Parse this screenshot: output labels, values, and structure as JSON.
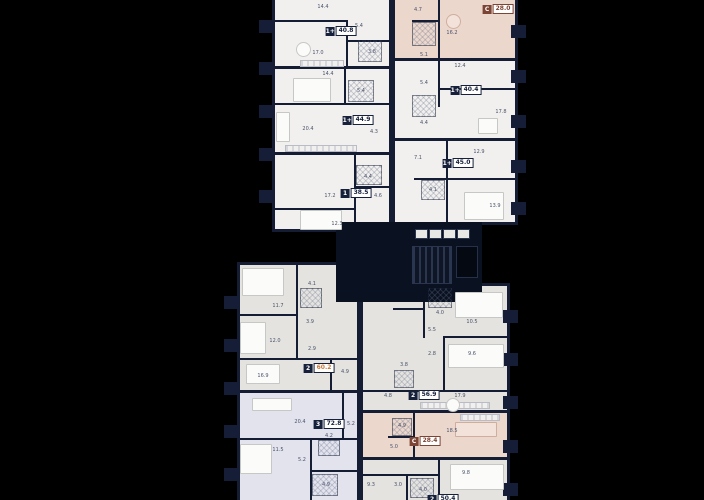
{
  "plan": {
    "name": "residential floor plan",
    "colors": {
      "background": "#000000",
      "wall": "#141d33",
      "floor_white": "#f1f0ee",
      "floor_gray": "#e4e3e0",
      "floor_pink": "#ecd7cd",
      "floor_lavender": "#e3e3ee",
      "badge_navy": "#16203a",
      "badge_brown": "#7b4434",
      "area_highlight_orange": "#c7793c",
      "room_label_text": "#49536b"
    }
  },
  "units": [
    {
      "type": "1+",
      "area": "40.8",
      "rooms": [
        "14.4",
        "5.4",
        "17.0",
        "3.8"
      ]
    },
    {
      "type": "1+",
      "area": "44.9",
      "rooms": [
        "14.4",
        "5.4",
        "20.4",
        "4.3"
      ]
    },
    {
      "type": "1",
      "area": "38.5",
      "rooms": [
        "4.4",
        "17.2",
        "4.6",
        "12.3"
      ]
    },
    {
      "type": "С",
      "area": "28.0",
      "rooms": [
        "4.7",
        "5.1",
        "16.2"
      ]
    },
    {
      "type": "1+",
      "area": "40.4",
      "rooms": [
        "12.4",
        "5.4",
        "4.4",
        "17.8"
      ]
    },
    {
      "type": "1+",
      "area": "45.0",
      "rooms": [
        "12.9",
        "7.1",
        "4.1",
        "13.9"
      ]
    },
    {
      "type": "2",
      "area": "60.2",
      "rooms": [
        "11.7",
        "4.1",
        "3.9",
        "12.0",
        "2.9",
        "16.9",
        "4.9"
      ]
    },
    {
      "type": "3",
      "area": "72.8",
      "rooms": [
        "20.4",
        "5.2",
        "11.5",
        "5.2",
        "4.2",
        "4.9"
      ]
    },
    {
      "type": "2",
      "area": "56.9",
      "rooms": [
        "4.0",
        "10.5",
        "5.5",
        "2.8",
        "9.6",
        "3.8",
        "4.8",
        "17.9"
      ]
    },
    {
      "type": "С",
      "area": "28.4",
      "rooms": [
        "4.9",
        "18.5",
        "5.0"
      ]
    },
    {
      "type": "2",
      "area": "50.4",
      "rooms": [
        "9.3",
        "3.0",
        "4.0",
        "9.8"
      ]
    }
  ]
}
